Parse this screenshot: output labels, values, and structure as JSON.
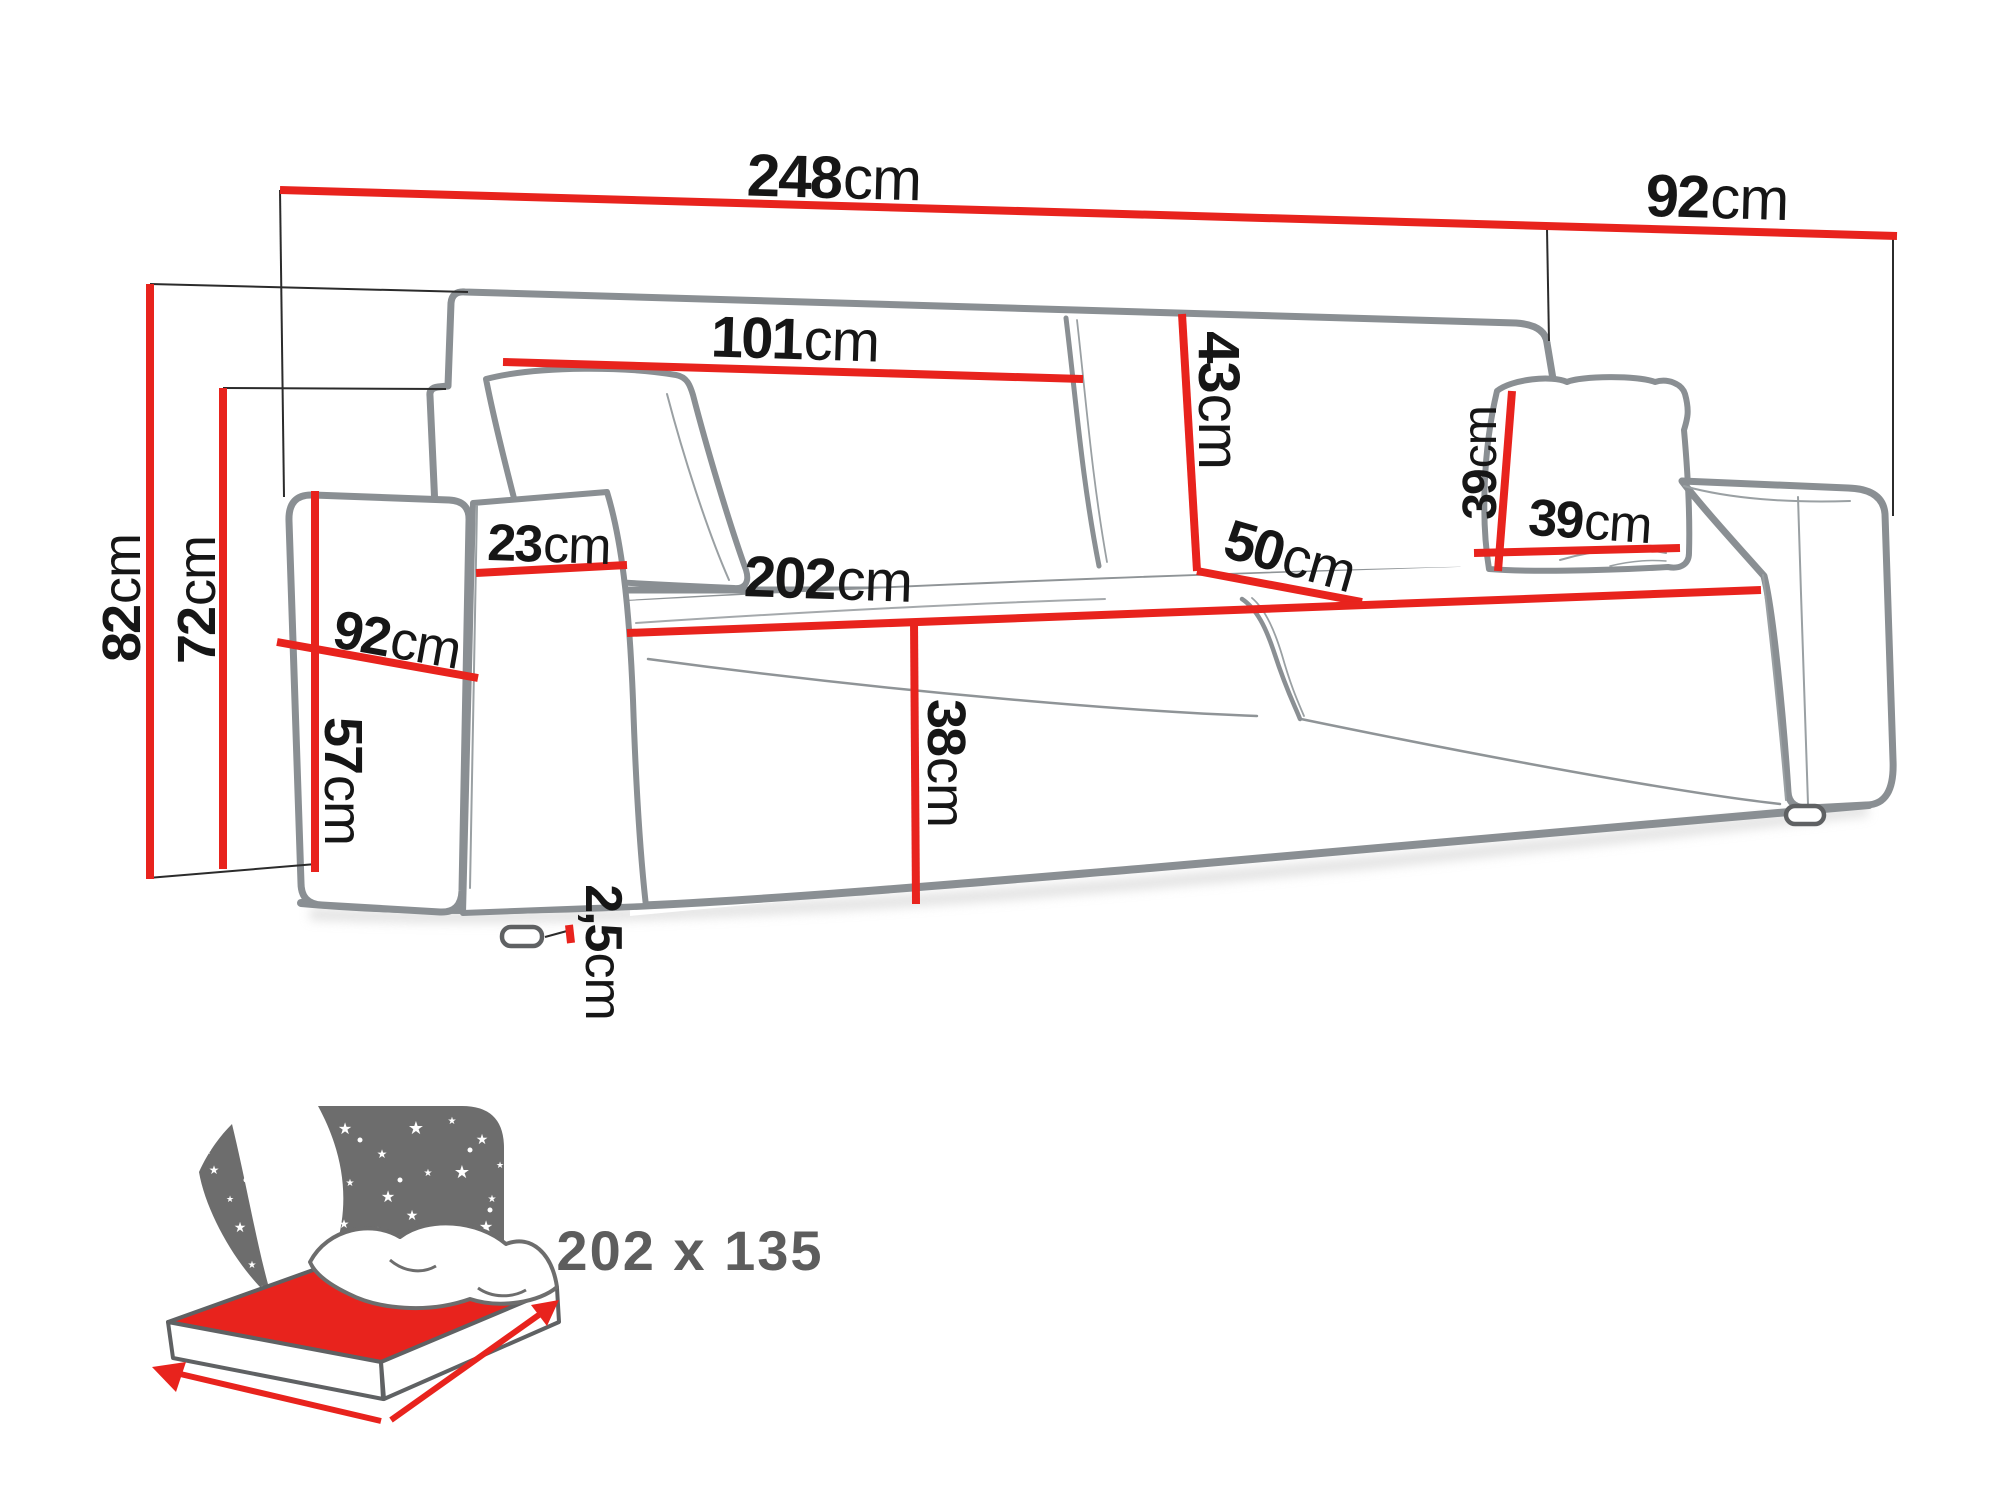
{
  "diagram": {
    "type": "sofa-dimension-diagram",
    "units": "cm",
    "dimensions": {
      "total_width": {
        "value": "248",
        "unit": "cm"
      },
      "total_depth": {
        "value": "92",
        "unit": "cm"
      },
      "backrest_width": {
        "value": "101",
        "unit": "cm"
      },
      "backrest_height": {
        "value": "43",
        "unit": "cm"
      },
      "seat_depth": {
        "value": "50",
        "unit": "cm"
      },
      "pillow_height": {
        "value": "39",
        "unit": "cm"
      },
      "pillow_width": {
        "value": "39",
        "unit": "cm"
      },
      "armrest_width": {
        "value": "23",
        "unit": "cm"
      },
      "armrest_depth": {
        "value": "92",
        "unit": "cm"
      },
      "armrest_height": {
        "value": "57",
        "unit": "cm"
      },
      "total_height": {
        "value": "82",
        "unit": "cm"
      },
      "frame_height": {
        "value": "72",
        "unit": "cm"
      },
      "seat_width": {
        "value": "202",
        "unit": "cm"
      },
      "seat_height": {
        "value": "38",
        "unit": "cm"
      },
      "leg_height": {
        "value": "2,5",
        "unit": "cm"
      }
    },
    "sleeping_area": {
      "label": "202 x 135"
    },
    "colors": {
      "dimension_line": "#e8231d",
      "sofa_outline": "#8a8f93",
      "label_text": "#161616",
      "icon_gray": "#6d6d6d",
      "sleeping_text": "#5d5d5d",
      "background": "#ffffff"
    }
  }
}
